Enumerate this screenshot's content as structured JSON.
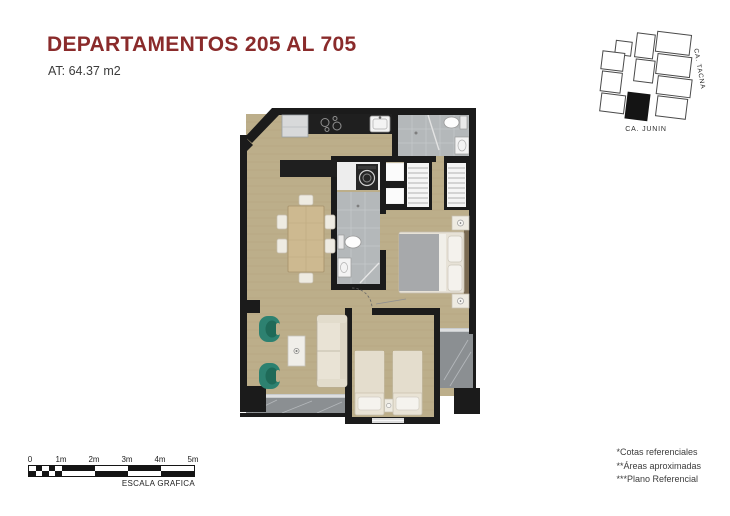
{
  "header": {
    "title": "DEPARTAMENTOS 205 AL 705",
    "subtitle": "AT: 64.37 m2"
  },
  "site_map": {
    "street_right": "CA. TACNA",
    "street_bottom": "CA. JUNIN"
  },
  "scale_bar": {
    "labels": [
      "0",
      "1m",
      "2m",
      "3m",
      "4m",
      "5m"
    ],
    "caption": "ESCALA GRAFICA"
  },
  "notes": [
    "*Cotas referenciales",
    "**Áreas aproximadas",
    "***Plano Referencial"
  ],
  "colors": {
    "accent": "#8a2b2b",
    "text": "#3c3c3c",
    "wall": "#1b1b1b",
    "wood": "#bcae8a",
    "wood_line": "#a3956f",
    "tile": "#b4b8ba",
    "tile_line": "#cbcfd1",
    "marble": "#8b8f92",
    "marble_line": "#bdc1c4",
    "counter": "#1f1f1f",
    "sofa": "#e9e3d5",
    "armchair": "#2d8170",
    "blanket": "#a7a9ab"
  }
}
